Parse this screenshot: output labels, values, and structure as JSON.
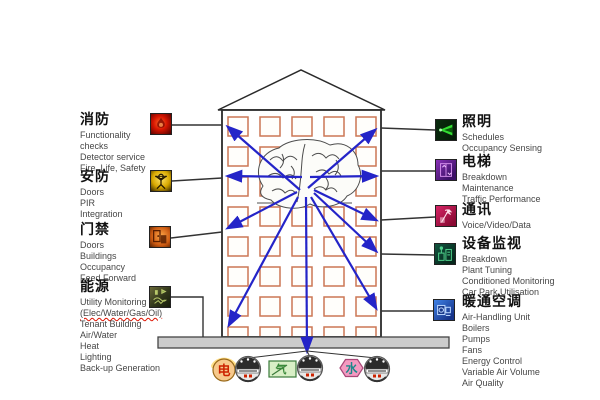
{
  "left_panels": [
    {
      "title": "消防",
      "icon": "fire-icon",
      "items": [
        "Functionality",
        "checks",
        "Detector service",
        "Fire, Life, Safety"
      ]
    },
    {
      "title": "安防",
      "icon": "security-icon",
      "items": [
        "Doors",
        "PIR",
        "Integration"
      ]
    },
    {
      "title": "门禁",
      "icon": "access-icon",
      "items": [
        "Doors",
        "Buildings",
        "Occupancy",
        "Feed Forward"
      ]
    },
    {
      "title": "能源",
      "icon": "energy-icon",
      "items": [
        "Utility Monitoring",
        "(Elec/Water/Gas/Oil)",
        "Tenant Building",
        "Air/Water",
        "Heat",
        "Lighting",
        "Back-up Generation"
      ]
    }
  ],
  "right_panels": [
    {
      "title": "照明",
      "icon": "lighting-icon",
      "items": [
        "Schedules",
        "Occupancy Sensing"
      ]
    },
    {
      "title": "电梯",
      "icon": "elevator-icon",
      "items": [
        "Breakdown",
        "Maintenance",
        "Traffic Performance"
      ]
    },
    {
      "title": "通讯",
      "icon": "comms-icon",
      "items": [
        "Voice/Video/Data"
      ]
    },
    {
      "title": "设备监视",
      "icon": "equipment-icon",
      "items": [
        "Breakdown",
        "Plant Tuning",
        "Conditioned Monitoring",
        "Car Park Utilisation"
      ]
    },
    {
      "title": "暖通空调",
      "icon": "hvac-icon",
      "items": [
        "Air-Handling Unit",
        "Boilers",
        "Pumps",
        "Fans",
        "Energy Control",
        "Variable Air Volume",
        "Air Quality"
      ]
    }
  ],
  "meters": {
    "electric": "电",
    "gas": "气",
    "water": "水"
  },
  "colors": {
    "arrow": "#2424c8",
    "connector": "#333333",
    "window_border": "#cc7755",
    "platform": "#cccccc"
  }
}
